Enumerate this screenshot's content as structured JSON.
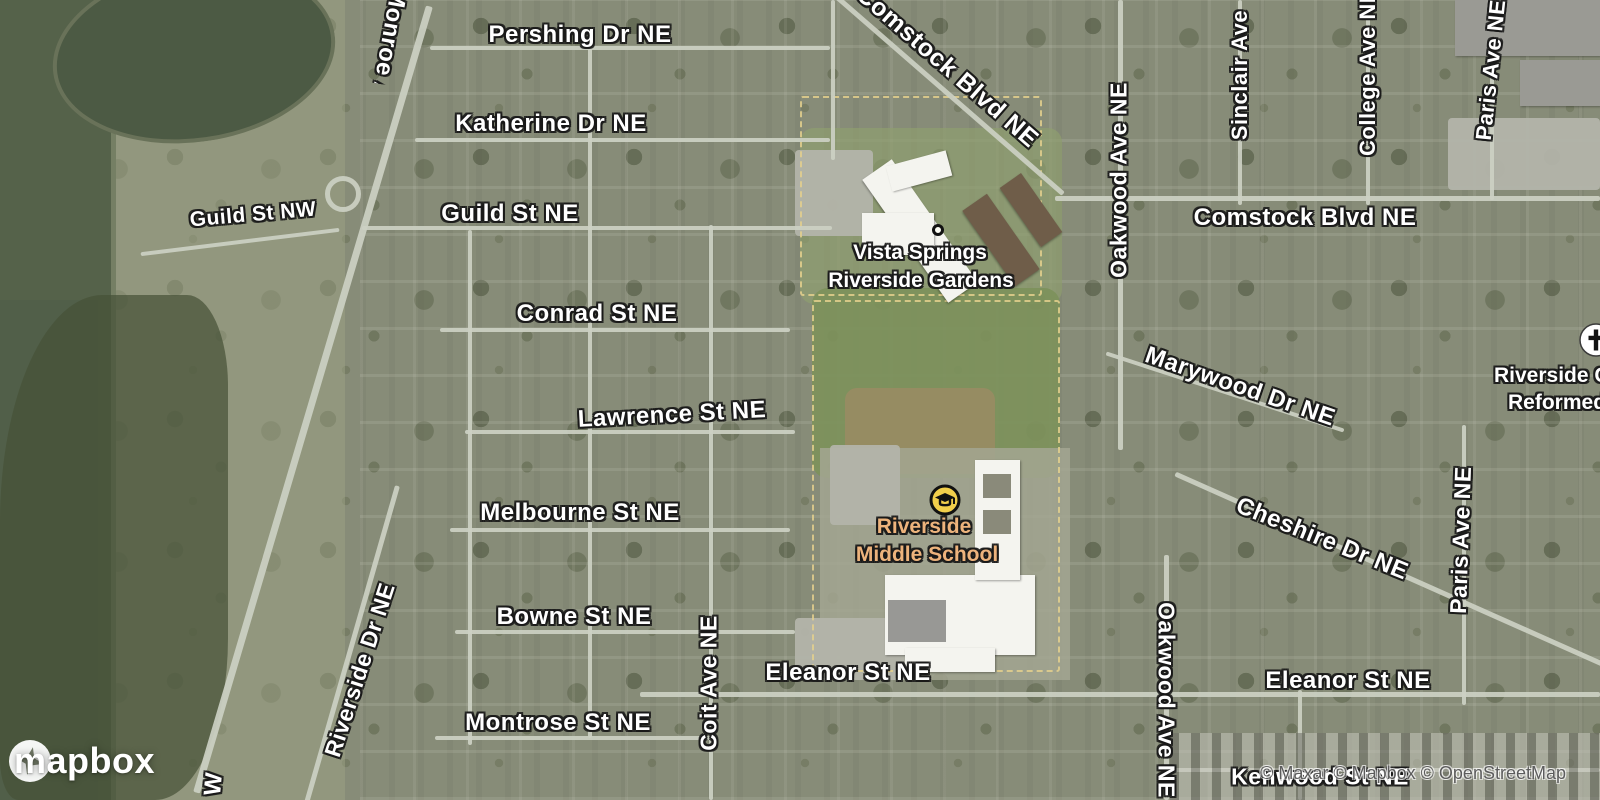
{
  "map_type": "satellite",
  "streets": {
    "pershing": "Pershing Dr NE",
    "katherine": "Katherine Dr NE",
    "guild_nw": "Guild St NW",
    "guild_ne": "Guild St NE",
    "conrad": "Conrad St NE",
    "lawrence": "Lawrence St NE",
    "melbourne": "Melbourne St NE",
    "bowne": "Bowne St NE",
    "montrose": "Montrose St NE",
    "eleanor_west": "Eleanor St NE",
    "eleanor_east": "Eleanor St NE",
    "kenwood": "Kenwood St NE",
    "comstock_diagonal": "Comstock Blvd NE",
    "comstock_east": "Comstock Blvd NE",
    "monroe": "Monroe Ave NW",
    "monroe_fragment": "W",
    "riverside_dr": "Riverside Dr NE",
    "coit": "Coit Ave NE",
    "oakwood_north": "Oakwood Ave NE",
    "oakwood_south": "Oakwood Ave NE",
    "sinclair": "Sinclair Ave",
    "college": "College Ave NE",
    "paris_north": "Paris Ave NE",
    "paris_south": "Paris Ave NE",
    "marywood": "Marywood Dr NE",
    "cheshire": "Cheshire Dr NE"
  },
  "pois": {
    "vista_springs": {
      "line1": "Vista Springs",
      "line2": "Riverside Gardens"
    },
    "school": {
      "line1": "Riverside",
      "line2": "Middle School"
    },
    "church": {
      "line1": "Riverside C",
      "line2": "Reformed"
    }
  },
  "logo": {
    "text": "mapbox"
  },
  "attribution": {
    "text": "© Maxar © Mapbox © OpenStreetMap"
  },
  "colors": {
    "street_label": "#ffffff",
    "street_label_halo": "#191919",
    "school_label": "#edb37c",
    "school_icon_fill": "#f2cf4b",
    "school_icon_stroke": "#111111",
    "church_icon_fill": "#ffffff",
    "church_icon_glyph": "#111111",
    "attribution_text": "#5c5c5c",
    "water": "#55624a",
    "field_green": "#7d915b"
  }
}
